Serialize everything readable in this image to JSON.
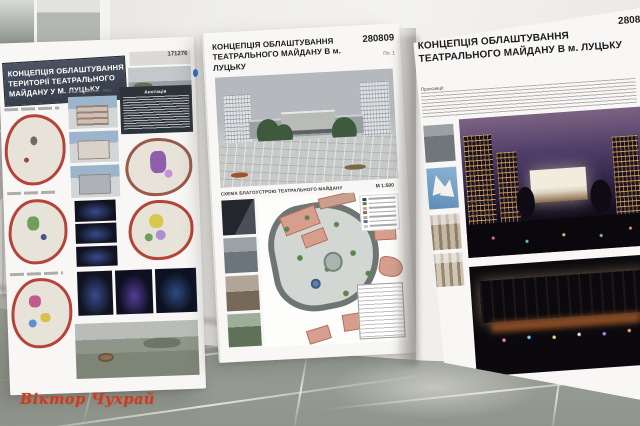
{
  "watermark": {
    "text": "Віктор Чухрай",
    "color": "#d03a1c"
  },
  "posters": {
    "left": {
      "title_lines": [
        "КОНЦЕПЦІЯ ОБЛАШТУВАННЯ",
        "ТЕРИТОРІЇ ТЕАТРАЛЬНОГО",
        "МАЙДАНУ У М. ЛУЦЬКУ"
      ],
      "code": "171276",
      "annotation_heading": "Анотація"
    },
    "middle": {
      "title_lines": [
        "КОНЦЕПЦІЯ ОБЛАШТУВАННЯ",
        "ТЕАТРАЛЬНОГО  МАЙДАНУ В м. ЛУЦЬКУ"
      ],
      "code": "280809",
      "sheet_label": "Пл. 1",
      "plan_caption": "СХЕМА БЛАГОУСТРОЮ ТЕАТРАЛЬНОГО МАЙДАНУ",
      "plan_scale": "М 1:500"
    },
    "right": {
      "title_lines": [
        "КОНЦЕПЦІЯ ОБЛАШТУВАННЯ",
        "ТЕАТРАЛЬНОГО  МАЙДАНУ В м. ЛУЦЬКУ"
      ],
      "code": "2808",
      "notes_heading": "Пропозиції:"
    }
  },
  "colors": {
    "wall": "#eeedeb",
    "floor": "#9ea39b",
    "header_band": "#3c4452",
    "accent_red": "#b5433a",
    "night_sky": "#54416b",
    "plan_building": "#d79e8e"
  }
}
